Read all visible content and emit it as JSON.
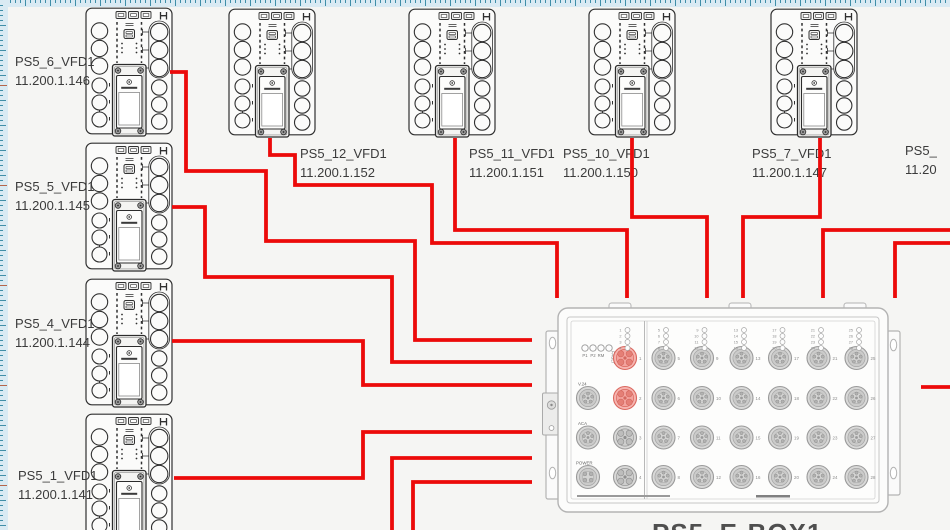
{
  "app": {
    "canvas_bg": "#f5f5f3",
    "ruler_bg": "#d9eaf3",
    "ruler_tick": "#3f8ea8",
    "ruler_accent": "#b5654a",
    "cable_color": "#ec0a0a",
    "device_stroke": "#303030",
    "switch_stroke": "#b3b3b3",
    "highlight_port_fill": "#f6b5b0",
    "highlight_port_stroke": "#db675e"
  },
  "devices": [
    {
      "name": "PS5_6_VFD1",
      "ip": "11.200.1.146",
      "x": 85,
      "y": 7,
      "label_x": 15,
      "label_y": 52
    },
    {
      "name": "PS5_5_VFD1",
      "ip": "11.200.1.145",
      "x": 85,
      "y": 142,
      "label_x": 15,
      "label_y": 177
    },
    {
      "name": "PS5_4_VFD1",
      "ip": "11.200.1.144",
      "x": 85,
      "y": 278,
      "label_x": 15,
      "label_y": 314
    },
    {
      "name": "PS5_1_VFD1",
      "ip": "11.200.1.141",
      "x": 85,
      "y": 413,
      "label_x": 18,
      "label_y": 466
    },
    {
      "name": "PS5_12_VFD1",
      "ip": "11.200.1.152",
      "x": 228,
      "y": 8,
      "label_x": 300,
      "label_y": 144
    },
    {
      "name": "PS5_11_VFD1",
      "ip": "11.200.1.151",
      "x": 408,
      "y": 8,
      "label_x": 469,
      "label_y": 144
    },
    {
      "name": "PS5_10_VFD1",
      "ip": "11.200.1.150",
      "x": 588,
      "y": 8,
      "label_x": 563,
      "label_y": 144
    },
    {
      "name": "PS5_7_VFD1",
      "ip": "11.200.1.147",
      "x": 770,
      "y": 8,
      "label_x": 752,
      "label_y": 144
    },
    {
      "name": "PS5_",
      "ip": "11.20",
      "x": null,
      "y": null,
      "label_x": 905,
      "label_y": 141
    }
  ],
  "cables": [
    "170,72 186,72 186,171 266,171 266,241 415,241 415,340 532,340",
    "172,207 205,207 205,277 392,277 392,362 532,362",
    "172,341 363,341 363,385 532,385",
    "174,478 363,478 363,432 532,432",
    "270,138 270,155 295,155 295,185 432,185 432,243 557,243 557,298",
    "455,138 455,230 627,230 627,298",
    "632,138 632,217 707,217 707,298",
    "820,138 820,217 743,217 743,298",
    "950,230 823,230 823,298",
    "950,243 895,243 895,298",
    "921,387 950,387",
    "392,532 392,458 532,458",
    "413,532 413,482 532,482"
  ],
  "switch": {
    "x": 540,
    "y": 295,
    "led_labels": [
      "P1",
      "P2",
      "RM",
      "FAULT"
    ],
    "side_ports": [
      "V.24",
      "ACA",
      "POWER"
    ],
    "port_count": 28,
    "ports_per_column": 4,
    "highlighted_ports": [
      1,
      2
    ],
    "caption": "PS5_E-BOX1"
  }
}
